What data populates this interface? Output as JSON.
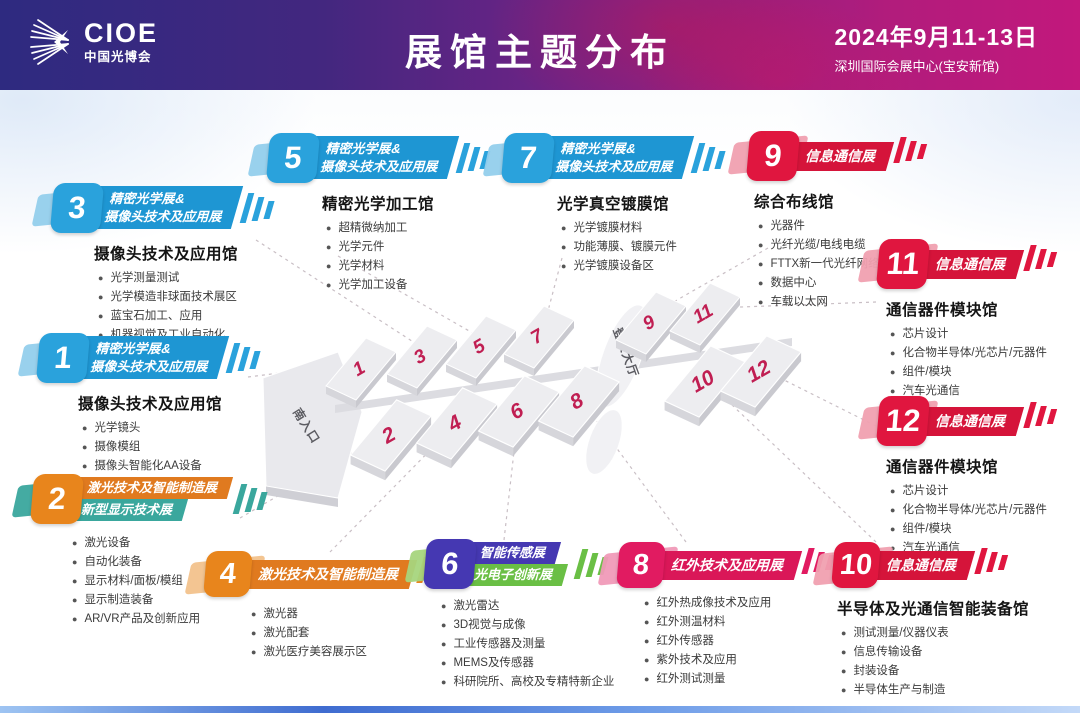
{
  "header": {
    "logo_text": "CIOE",
    "logo_subtext": "中国光博会",
    "title": "展馆主题分布",
    "date": "2024年9月11-13日",
    "venue": "深圳国际会展中心(宝安新馆)"
  },
  "map": {
    "south_entrance": "南入口",
    "lobby": "登录大厅",
    "highlighted_hall": "5"
  },
  "colors": {
    "precision_optics_blue": "#1e96d3",
    "info_comm_red": "#d5143a",
    "laser_orange": "#e07a1f",
    "new_display_teal": "#3aa79d",
    "smart_sensor_indigo": "#4538b2",
    "optoelectronic_green": "#6abf45",
    "infrared_magenta": "#da1758",
    "map_highlight_orange": "#f5a319",
    "hall_number_crimson": "#c01e52"
  },
  "halls": [
    {
      "number": "1",
      "show": [
        "精密光学展&",
        "摄像头技术及应用展"
      ],
      "hall_title": "摄像头技术及应用馆",
      "items": [
        "光学镜头",
        "摄像模组",
        "摄像头智能化AA设备"
      ]
    },
    {
      "number": "2",
      "show": [
        "激光技术及智能制造展",
        "新型显示技术展"
      ],
      "hall_title": "",
      "items": [
        "激光设备",
        "自动化装备",
        "显示材料/面板/模组",
        "显示制造装备",
        "AR/VR产品及创新应用"
      ]
    },
    {
      "number": "3",
      "show": [
        "精密光学展&",
        "摄像头技术及应用展"
      ],
      "hall_title": "摄像头技术及应用馆",
      "items": [
        "光学测量测试",
        "光学模造非球面技术展区",
        "蓝宝石加工、应用",
        "机器视觉及工业自动化"
      ]
    },
    {
      "number": "4",
      "show": [
        "激光技术及智能制造展"
      ],
      "hall_title": "",
      "items": [
        "激光器",
        "激光配套",
        "激光医疗美容展示区"
      ]
    },
    {
      "number": "5",
      "show": [
        "精密光学展&",
        "摄像头技术及应用展"
      ],
      "hall_title": "精密光学加工馆",
      "items": [
        "超精微纳加工",
        "光学元件",
        "光学材料",
        "光学加工设备"
      ]
    },
    {
      "number": "6",
      "show": [
        "智能传感展",
        "光电子创新展"
      ],
      "hall_title": "",
      "items": [
        "激光雷达",
        "3D视觉与成像",
        "工业传感器及测量",
        "MEMS及传感器",
        "科研院所、高校及专精特新企业"
      ]
    },
    {
      "number": "7",
      "show": [
        "精密光学展&",
        "摄像头技术及应用展"
      ],
      "hall_title": "光学真空镀膜馆",
      "items": [
        "光学镀膜材料",
        "功能薄膜、镀膜元件",
        "光学镀膜设备区"
      ]
    },
    {
      "number": "8",
      "show": [
        "红外技术及应用展"
      ],
      "hall_title": "",
      "items": [
        "红外热成像技术及应用",
        "红外测温材料",
        "红外传感器",
        "紫外技术及应用",
        "红外测试测量"
      ]
    },
    {
      "number": "9",
      "show": [
        "信息通信展"
      ],
      "hall_title": "综合布线馆",
      "items": [
        "光器件",
        "光纤光缆/电线电缆",
        "FTTX新一代光纤网络",
        "数据中心",
        "车载以太网"
      ]
    },
    {
      "number": "10",
      "show": [
        "信息通信展"
      ],
      "hall_title": "半导体及光通信智能装备馆",
      "items": [
        "测试测量/仪器仪表",
        "信息传输设备",
        "封装设备",
        "半导体生产与制造"
      ]
    },
    {
      "number": "11",
      "show": [
        "信息通信展"
      ],
      "hall_title": "通信器件模块馆",
      "items": [
        "芯片设计",
        "化合物半导体/光芯片/元器件",
        "组件/模块",
        "汽车光通信"
      ]
    },
    {
      "number": "12",
      "show": [
        "信息通信展"
      ],
      "hall_title": "通信器件模块馆",
      "items": [
        "芯片设计",
        "化合物半导体/光芯片/元器件",
        "组件/模块",
        "汽车光通信"
      ]
    }
  ]
}
